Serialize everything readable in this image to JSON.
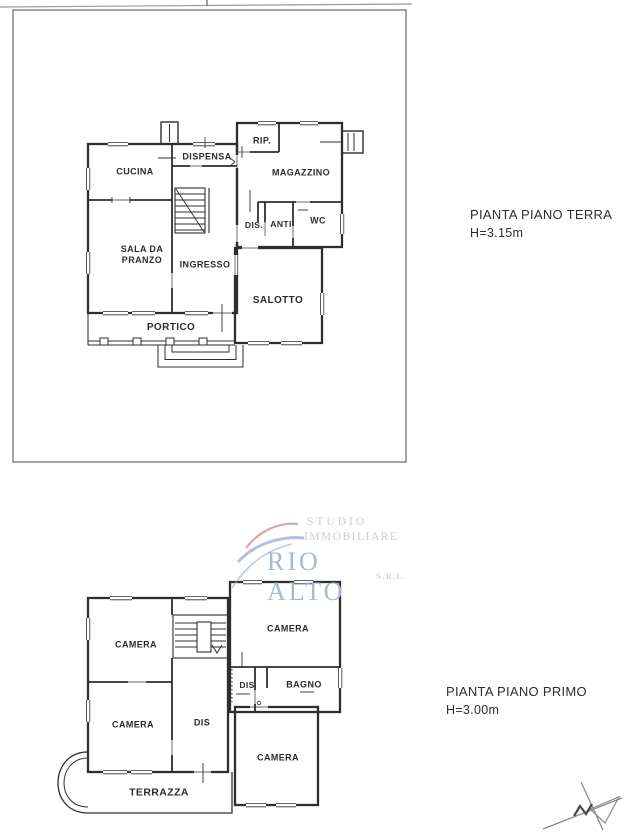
{
  "ground_floor": {
    "title": "PIANTA PIANO TERRA",
    "height_label": "H=3.15m",
    "rooms": {
      "cucina": "CUCINA",
      "dispensa": "DISPENSA",
      "rip": "RIP.",
      "magazzino": "MAGAZZINO",
      "sala_da_pranzo": "SALA DA\nPRANZO",
      "ingresso": "INGRESSO",
      "dis": "DIS.",
      "anti": "ANTI",
      "wc": "WC",
      "salotto": "SALOTTO",
      "portico": "PORTICO"
    }
  },
  "first_floor": {
    "title": "PIANTA PIANO PRIMO",
    "height_label": "H=3.00m",
    "rooms": {
      "camera_nw": "CAMERA",
      "camera_ne": "CAMERA",
      "dis_center": "DIS",
      "bagno": "BAGNO",
      "camera_sw": "CAMERA",
      "dis_west": "DIS",
      "camera_se": "CAMERA",
      "terrazza": "TERRAZZA"
    }
  },
  "watermark": {
    "studio": "STUDIO",
    "immobiliare": "IMMOBILIARE",
    "brand": "RIO ALTO",
    "srl": "S.R.L.",
    "brand_color": "#a9b7d6",
    "small_text_color": "#c6cdda",
    "swoosh_red": "#cf8f8f",
    "swoosh_blue": "#9aa9d1"
  },
  "icons": {
    "north_arrow": "north-arrow"
  }
}
